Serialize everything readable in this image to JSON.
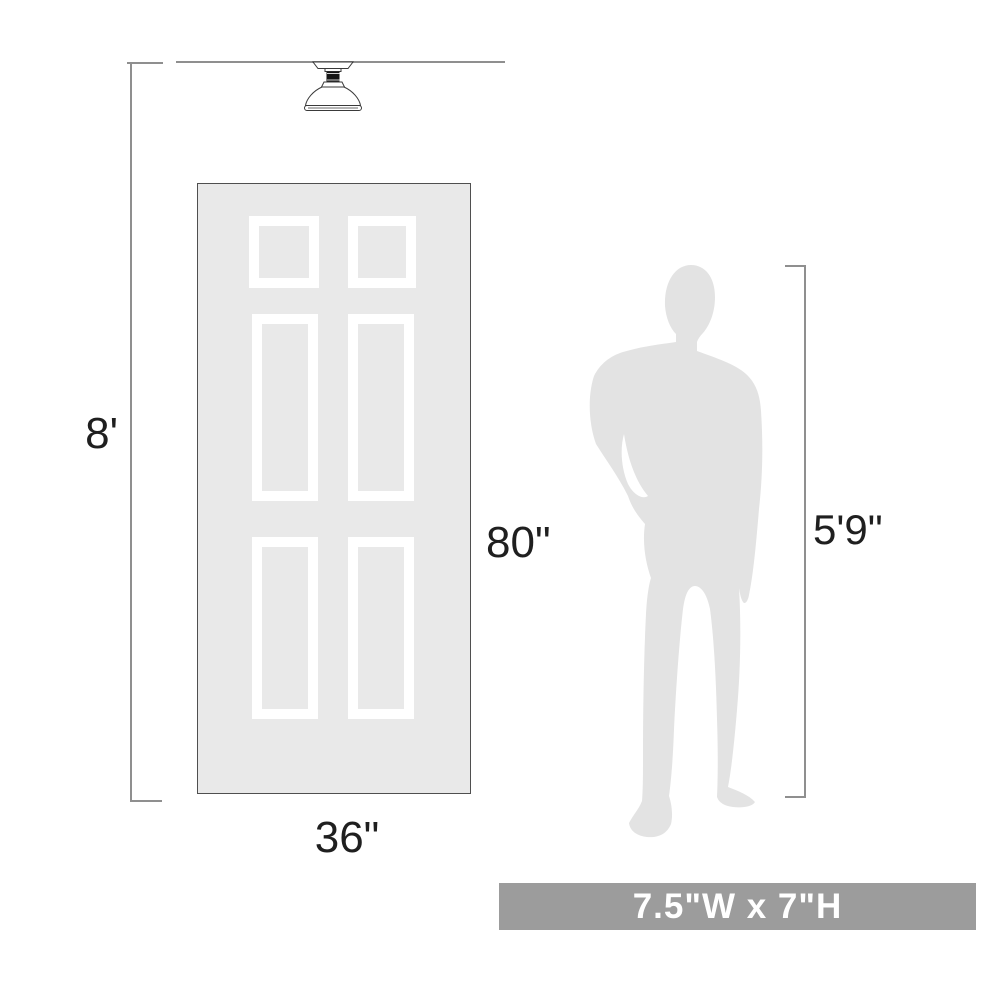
{
  "labels": {
    "ceiling_height": "8'",
    "door_height": "80\"",
    "door_width": "36\"",
    "person_height": "5'9\"",
    "product_size": "7.5\"W x 7\"H"
  },
  "icons": {
    "fixture": "flush-mount-ceiling-light-icon",
    "door": "six-panel-door",
    "person": "man-silhouette"
  },
  "colors": {
    "background": "#ffffff",
    "dimension_line": "#8f8f8f",
    "label_text": "#1f1f1f",
    "door_fill": "#e9e9e9",
    "door_border": "#4f4f4f",
    "panel_frame": "#ffffff",
    "person_fill": "#e3e3e3",
    "banner_background": "#9c9c9c",
    "banner_text": "#ffffff",
    "fixture_outline": "#3a3a3a",
    "fixture_neck": "#161616"
  }
}
